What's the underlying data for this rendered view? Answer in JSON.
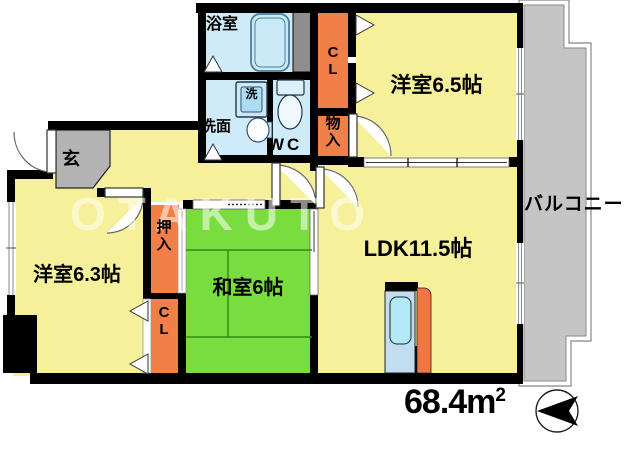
{
  "floorplan": {
    "rooms": {
      "bath": {
        "label": "浴室"
      },
      "washroom": {
        "label": "洗面"
      },
      "washer": {
        "label": "洗"
      },
      "wc": {
        "label": "WC"
      },
      "closet_top": {
        "label": "C\nL"
      },
      "storage_top": {
        "label": "物\n入"
      },
      "western_room_1": {
        "label": "洋室6.5帖"
      },
      "balcony": {
        "label": "バルコニー"
      },
      "entrance": {
        "label": "玄"
      },
      "western_room_2": {
        "label": "洋室6.3帖"
      },
      "oshiire": {
        "label": "押\n入"
      },
      "closet_left": {
        "label": "C\nL"
      },
      "japanese_room": {
        "label": "和室6帖"
      },
      "ldk": {
        "label": "LDK11.5帖"
      }
    },
    "area": {
      "value": "68.4m",
      "superscript": "2"
    },
    "watermark": "OTAKUTO",
    "colors": {
      "wall": "#000000",
      "room_yellow": "#F7F09A",
      "tatami_green": "#79DD40",
      "closet_orange": "#F08048",
      "wet_area_blue": "#CFEAF8",
      "balcony_gray": "#C5C5C5",
      "entrance_gray": "#B3B3B3",
      "shaft_gray": "#8E8E8E"
    }
  }
}
